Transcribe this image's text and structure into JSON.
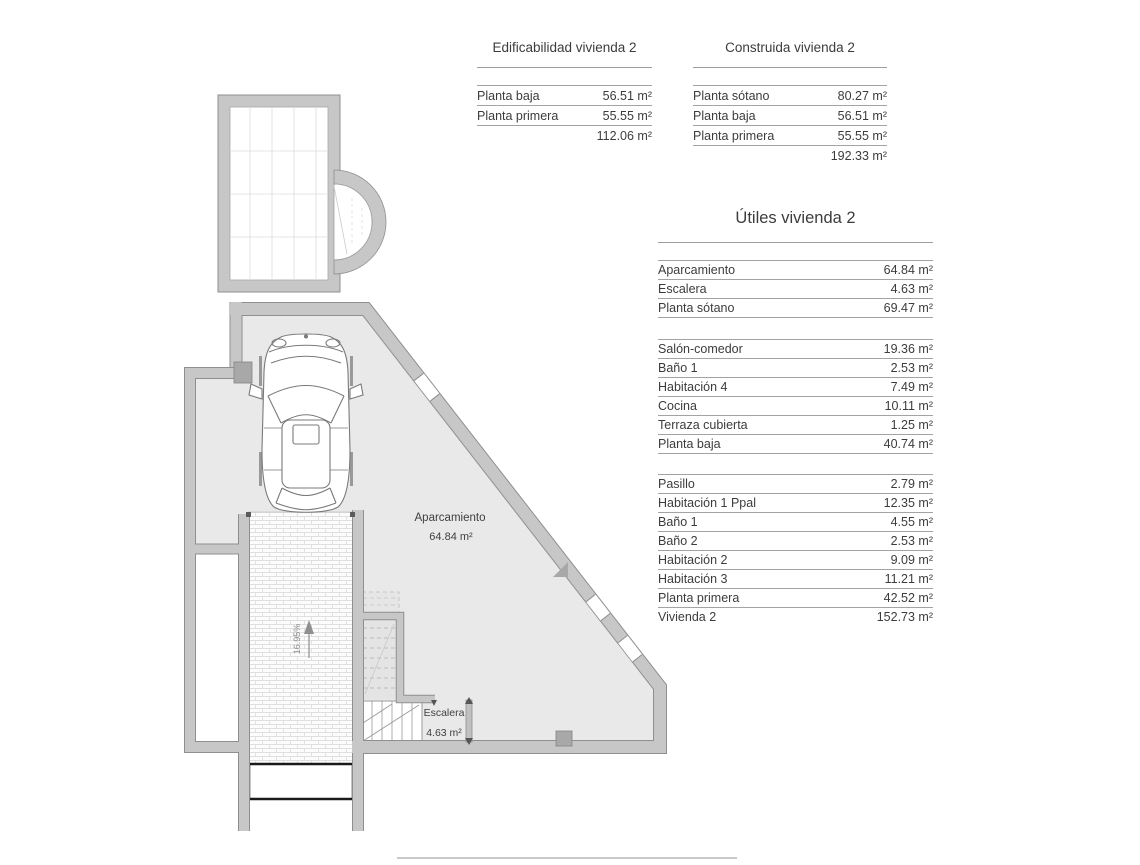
{
  "tables": {
    "edificabilidad": {
      "title": "Edificabilidad vivienda 2",
      "rows": [
        {
          "label": "Planta baja",
          "value": "56.51 m²"
        },
        {
          "label": "Planta primera",
          "value": "55.55 m²"
        }
      ],
      "total": "112.06 m²"
    },
    "construida": {
      "title": "Construida vivienda 2",
      "rows": [
        {
          "label": "Planta sótano",
          "value": "80.27 m²"
        },
        {
          "label": "Planta baja",
          "value": "56.51 m²"
        },
        {
          "label": "Planta primera",
          "value": "55.55 m²"
        }
      ],
      "total": "192.33 m²"
    },
    "utiles": {
      "title": "Útiles vivienda 2",
      "sections": [
        {
          "rows": [
            {
              "label": "Aparcamiento",
              "value": "64.84 m²"
            },
            {
              "label": "Escalera",
              "value": "4.63 m²"
            },
            {
              "label": "Planta sótano",
              "value": "69.47 m²"
            }
          ]
        },
        {
          "rows": [
            {
              "label": "Salón-comedor",
              "value": "19.36 m²"
            },
            {
              "label": "Baño 1",
              "value": "2.53 m²"
            },
            {
              "label": "Habitación 4",
              "value": "7.49 m²"
            },
            {
              "label": "Cocina",
              "value": "10.11 m²"
            },
            {
              "label": "Terraza cubierta",
              "value": "1.25 m²"
            },
            {
              "label": "Planta baja",
              "value": "40.74 m²"
            }
          ]
        },
        {
          "rows": [
            {
              "label": "Pasillo",
              "value": "2.79 m²"
            },
            {
              "label": "Habitación 1 Ppal",
              "value": "12.35 m²"
            },
            {
              "label": "Baño 1",
              "value": "4.55 m²"
            },
            {
              "label": "Baño 2",
              "value": "2.53 m²"
            },
            {
              "label": "Habitación 2",
              "value": "9.09 m²"
            },
            {
              "label": "Habitación 3",
              "value": "11.21 m²"
            },
            {
              "label": "Planta primera",
              "value": "42.52 m²"
            },
            {
              "label": "Vivienda 2",
              "value": "152.73 m²"
            }
          ]
        }
      ]
    }
  },
  "plan": {
    "labels": {
      "aparcamiento": "Aparcamiento",
      "aparcamiento_area": "64.84 m²",
      "escalera": "Escalera",
      "escalera_area": "4.63 m²",
      "ramp_slope": "16.95%"
    }
  },
  "colors": {
    "wall_fill": "#c7c7c7",
    "wall_edge": "#8f8f8f",
    "floor": "#e9e9e9",
    "pillar": "#a8a8a8",
    "rule_line": "#a3a3a3",
    "text": "#3c3c3c"
  }
}
